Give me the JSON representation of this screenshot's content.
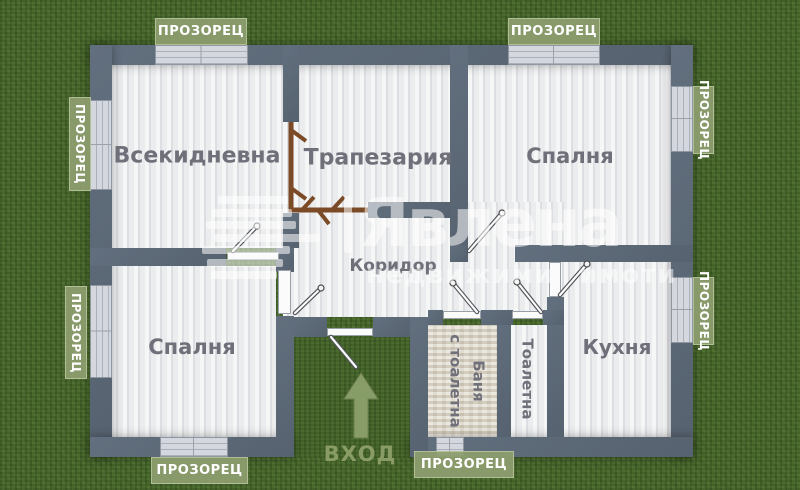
{
  "brand": {
    "name": "Явлена",
    "tagline": "недвижими имоти"
  },
  "plan": {
    "window_label": "ПРОЗОРЕЦ",
    "entrance_label": "ВХОД",
    "rooms": {
      "living": "Всекидневна",
      "dining": "Трапезария",
      "bedroom_top": "Спалня",
      "bedroom_bottom": "Спалня",
      "corridor": "Коридор",
      "kitchen": "Кухня",
      "toilet": "Тоалетна",
      "bath_line1": "Баня",
      "bath_line2": "с тоалетна"
    },
    "colors": {
      "grass_green": "#4b6a2f",
      "wall_gray": "#5b6877",
      "floor_light": "#e9eaec",
      "bath_floor_beige": "#d8d2c4",
      "label_olive": "#8d9d6e",
      "door_brown": "#7b4a26",
      "room_text_gray": "#70707a",
      "watermark_white": "rgba(255,255,255,0.55)"
    }
  }
}
